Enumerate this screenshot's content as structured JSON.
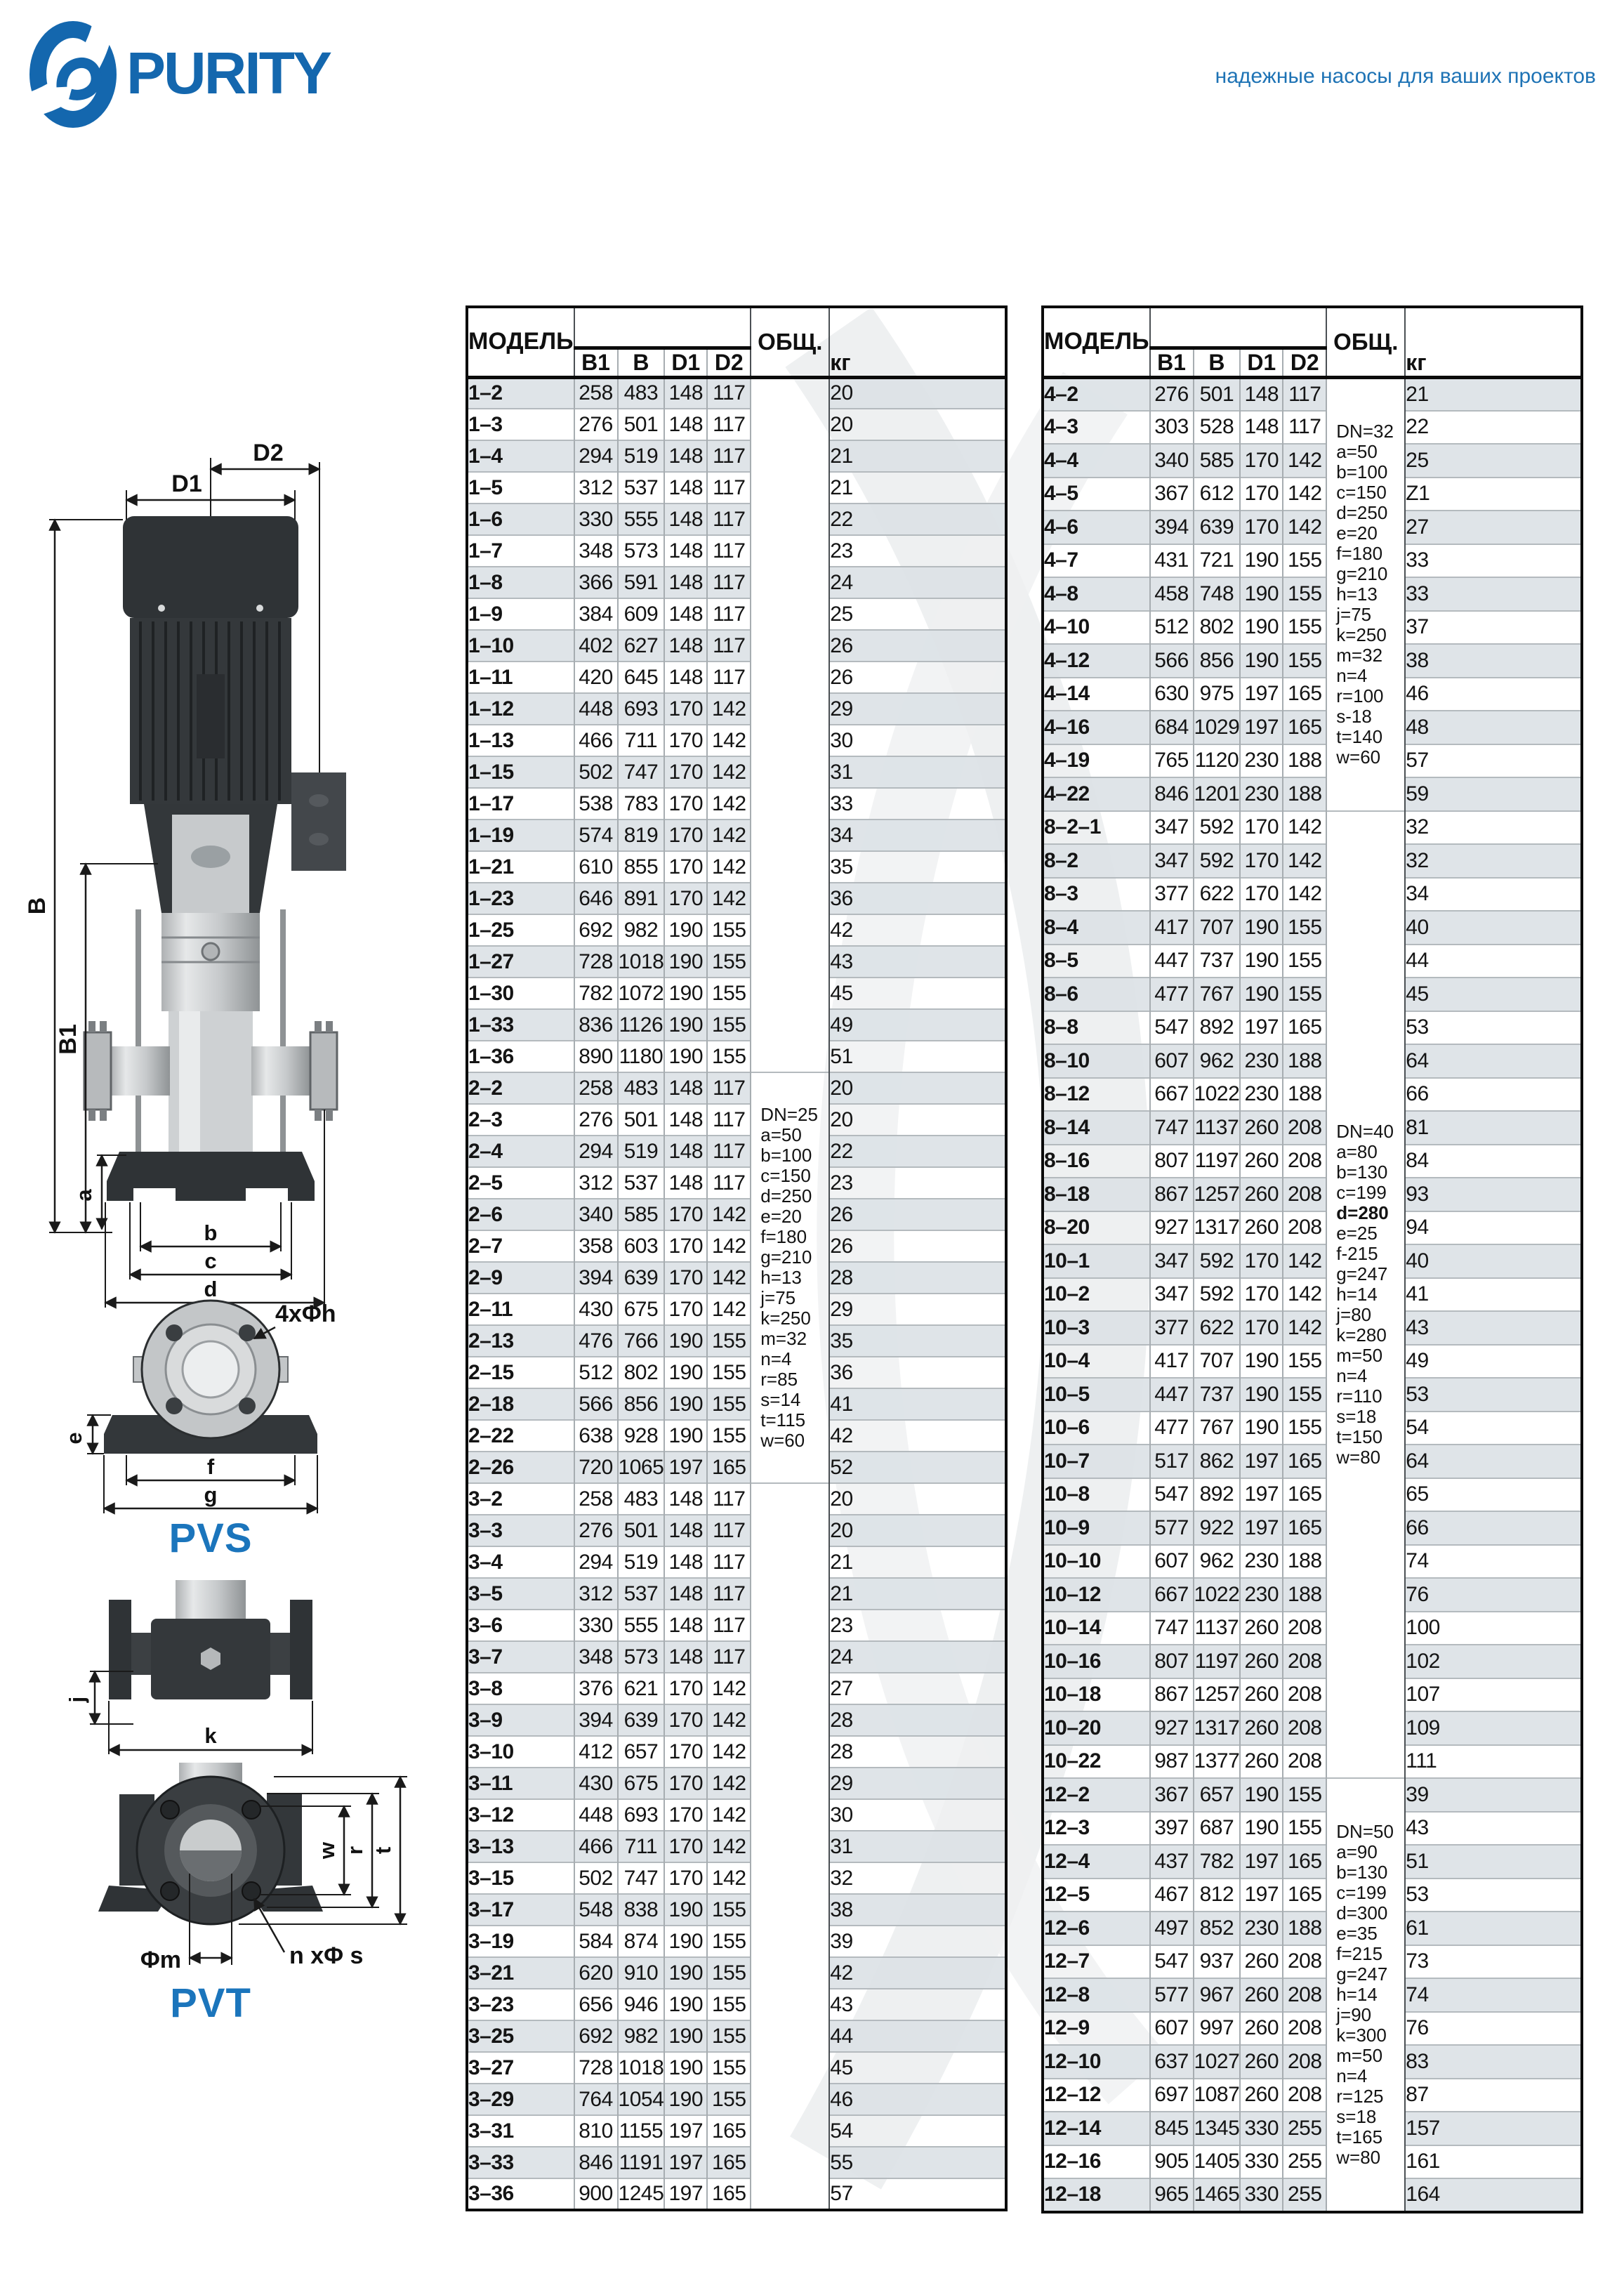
{
  "header": {
    "brand": "PURITY",
    "tagline": "надежные насосы для ваших проектов",
    "brand_color": "#1467ae",
    "accent_blue": "#1b75bc"
  },
  "diagram": {
    "dim_d2": "D2",
    "dim_d1": "D1",
    "dim_b": "B",
    "dim_b1": "B1",
    "dim_a": "a",
    "dim_b_small": "b",
    "dim_c": "c",
    "dim_d_small": "d",
    "dim_e": "e",
    "dim_f": "f",
    "dim_g": "g",
    "bolt_note_pvs": "4xΦh",
    "dim_j": "j",
    "dim_k": "k",
    "dim_m": "Φm",
    "bolt_note_pvt": "n xΦ s",
    "dim_w": "w",
    "dim_r": "r",
    "dim_t": "t",
    "pvs_label": "PVS",
    "pvt_label": "PVT"
  },
  "tables": [
    {
      "headers": {
        "model": "МОДЕЛЬ",
        "b1": "B1",
        "b": "B",
        "d1": "D1",
        "d2": "D2",
        "common": "ОБЩ.",
        "kg": "кг"
      },
      "group_starts": [
        22,
        35
      ],
      "note_cells": [
        {
          "start": 0,
          "span": 22,
          "lines": []
        },
        {
          "start": 22,
          "span": 13,
          "lines": [
            "DN=25",
            "a=50",
            "b=100",
            "c=150",
            "d=250",
            "e=20",
            "f=180",
            "g=210",
            "h=13",
            "j=75",
            "k=250",
            "m=32",
            "n=4",
            "r=85",
            "s=14",
            "t=115",
            "w=60"
          ]
        },
        {
          "start": 35,
          "span": 23,
          "lines": []
        }
      ],
      "rows": [
        [
          "1–2",
          258,
          483,
          148,
          117,
          20
        ],
        [
          "1–3",
          276,
          501,
          148,
          117,
          20
        ],
        [
          "1–4",
          294,
          519,
          148,
          117,
          21
        ],
        [
          "1–5",
          312,
          537,
          148,
          117,
          21
        ],
        [
          "1–6",
          330,
          555,
          148,
          117,
          22
        ],
        [
          "1–7",
          348,
          573,
          148,
          117,
          23
        ],
        [
          "1–8",
          366,
          591,
          148,
          117,
          24
        ],
        [
          "1–9",
          384,
          609,
          148,
          117,
          25
        ],
        [
          "1–10",
          402,
          627,
          148,
          117,
          26
        ],
        [
          "1–11",
          420,
          645,
          148,
          117,
          26
        ],
        [
          "1–12",
          448,
          693,
          170,
          142,
          29
        ],
        [
          "1–13",
          466,
          711,
          170,
          142,
          30
        ],
        [
          "1–15",
          502,
          747,
          170,
          142,
          31
        ],
        [
          "1–17",
          538,
          783,
          170,
          142,
          33
        ],
        [
          "1–19",
          574,
          819,
          170,
          142,
          34
        ],
        [
          "1–21",
          610,
          855,
          170,
          142,
          35
        ],
        [
          "1–23",
          646,
          891,
          170,
          142,
          36
        ],
        [
          "1–25",
          692,
          982,
          190,
          155,
          42
        ],
        [
          "1–27",
          728,
          1018,
          190,
          155,
          43
        ],
        [
          "1–30",
          782,
          1072,
          190,
          155,
          45
        ],
        [
          "1–33",
          836,
          1126,
          190,
          155,
          49
        ],
        [
          "1–36",
          890,
          1180,
          190,
          155,
          51
        ],
        [
          "2–2",
          258,
          483,
          148,
          117,
          20
        ],
        [
          "2–3",
          276,
          501,
          148,
          117,
          20
        ],
        [
          "2–4",
          294,
          519,
          148,
          117,
          22
        ],
        [
          "2–5",
          312,
          537,
          148,
          117,
          23
        ],
        [
          "2–6",
          340,
          585,
          170,
          142,
          26
        ],
        [
          "2–7",
          358,
          603,
          170,
          142,
          26
        ],
        [
          "2–9",
          394,
          639,
          170,
          142,
          28
        ],
        [
          "2–11",
          430,
          675,
          170,
          142,
          29
        ],
        [
          "2–13",
          476,
          766,
          190,
          155,
          35
        ],
        [
          "2–15",
          512,
          802,
          190,
          155,
          36
        ],
        [
          "2–18",
          566,
          856,
          190,
          155,
          41
        ],
        [
          "2–22",
          638,
          928,
          190,
          155,
          42
        ],
        [
          "2–26",
          720,
          1065,
          197,
          165,
          52
        ],
        [
          "3–2",
          258,
          483,
          148,
          117,
          20
        ],
        [
          "3–3",
          276,
          501,
          148,
          117,
          20
        ],
        [
          "3–4",
          294,
          519,
          148,
          117,
          21
        ],
        [
          "3–5",
          312,
          537,
          148,
          117,
          21
        ],
        [
          "3–6",
          330,
          555,
          148,
          117,
          23
        ],
        [
          "3–7",
          348,
          573,
          148,
          117,
          24
        ],
        [
          "3–8",
          376,
          621,
          170,
          142,
          27
        ],
        [
          "3–9",
          394,
          639,
          170,
          142,
          28
        ],
        [
          "3–10",
          412,
          657,
          170,
          142,
          28
        ],
        [
          "3–11",
          430,
          675,
          170,
          142,
          29
        ],
        [
          "3–12",
          448,
          693,
          170,
          142,
          30
        ],
        [
          "3–13",
          466,
          711,
          170,
          142,
          31
        ],
        [
          "3–15",
          502,
          747,
          170,
          142,
          32
        ],
        [
          "3–17",
          548,
          838,
          190,
          155,
          38
        ],
        [
          "3–19",
          584,
          874,
          190,
          155,
          39
        ],
        [
          "3–21",
          620,
          910,
          190,
          155,
          42
        ],
        [
          "3–23",
          656,
          946,
          190,
          155,
          43
        ],
        [
          "3–25",
          692,
          982,
          190,
          155,
          44
        ],
        [
          "3–27",
          728,
          1018,
          190,
          155,
          45
        ],
        [
          "3–29",
          764,
          1054,
          190,
          155,
          46
        ],
        [
          "3–31",
          810,
          1155,
          197,
          165,
          54
        ],
        [
          "3–33",
          846,
          1191,
          197,
          165,
          55
        ],
        [
          "3–36",
          900,
          1245,
          197,
          165,
          57
        ]
      ]
    },
    {
      "headers": {
        "model": "МОДЕЛЬ",
        "b1": "B1",
        "b": "B",
        "d1": "D1",
        "d2": "D2",
        "common": "ОБЩ.",
        "kg": "кг"
      },
      "group_starts": [
        13,
        26,
        42
      ],
      "note_cells": [
        {
          "start": 0,
          "span": 13,
          "lines": [
            "DN=32",
            "a=50",
            "b=100",
            "c=150",
            "d=250",
            "e=20",
            "f=180",
            "g=210",
            "h=13",
            "j=75",
            "k=250",
            "m=32",
            "n=4",
            "r=100",
            "s-18",
            "t=140",
            "w=60"
          ]
        },
        {
          "start": 13,
          "span": 29,
          "lines": [
            "DN=40",
            "a=80",
            "b=130",
            "c=199",
            {
              "t": "d=280",
              "bold": true
            },
            "e=25",
            "f-215",
            "g=247",
            "h=14",
            "j=80",
            "k=280",
            "m=50",
            "n=4",
            "r=110",
            "s=18",
            "t=150",
            "w=80"
          ]
        },
        {
          "start": 42,
          "span": 13,
          "lines": [
            "DN=50",
            "a=90",
            "b=130",
            "c=199",
            "d=300",
            "e=35",
            "f=215",
            "g=247",
            "h=14",
            "j=90",
            "k=300",
            "m=50",
            "n=4",
            "r=125",
            "s=18",
            "t=165",
            "w=80"
          ]
        }
      ],
      "rows": [
        [
          "4–2",
          276,
          501,
          148,
          117,
          21
        ],
        [
          "4–3",
          303,
          528,
          148,
          117,
          22
        ],
        [
          "4–4",
          340,
          585,
          170,
          142,
          25
        ],
        [
          "4–5",
          367,
          612,
          170,
          142,
          "Z1"
        ],
        [
          "4–6",
          394,
          639,
          170,
          142,
          27
        ],
        [
          "4–7",
          431,
          721,
          190,
          155,
          33
        ],
        [
          "4–8",
          458,
          748,
          190,
          155,
          33
        ],
        [
          "4–10",
          512,
          802,
          190,
          155,
          37
        ],
        [
          "4–12",
          566,
          856,
          190,
          155,
          38
        ],
        [
          "4–14",
          630,
          975,
          197,
          165,
          46
        ],
        [
          "4–16",
          684,
          1029,
          197,
          165,
          48
        ],
        [
          "4–19",
          765,
          1120,
          230,
          188,
          57
        ],
        [
          "4–22",
          846,
          1201,
          230,
          188,
          59
        ],
        [
          "8–2–1",
          347,
          592,
          170,
          142,
          32
        ],
        [
          "8–2",
          347,
          592,
          170,
          142,
          32
        ],
        [
          "8–3",
          377,
          622,
          170,
          142,
          34
        ],
        [
          "8–4",
          417,
          707,
          190,
          155,
          40
        ],
        [
          "8–5",
          447,
          737,
          190,
          155,
          44
        ],
        [
          "8–6",
          477,
          767,
          190,
          155,
          45
        ],
        [
          "8–8",
          547,
          892,
          197,
          165,
          53
        ],
        [
          "8–10",
          607,
          962,
          230,
          188,
          64
        ],
        [
          "8–12",
          667,
          1022,
          230,
          188,
          66
        ],
        [
          "8–14",
          747,
          1137,
          260,
          208,
          81
        ],
        [
          "8–16",
          807,
          1197,
          260,
          208,
          84
        ],
        [
          "8–18",
          867,
          1257,
          260,
          208,
          93
        ],
        [
          "8–20",
          927,
          1317,
          260,
          208,
          94
        ],
        [
          "10–1",
          347,
          592,
          170,
          142,
          40
        ],
        [
          "10–2",
          347,
          592,
          170,
          142,
          41
        ],
        [
          "10–3",
          377,
          622,
          170,
          142,
          43
        ],
        [
          "10–4",
          417,
          707,
          190,
          155,
          49
        ],
        [
          "10–5",
          447,
          737,
          190,
          155,
          53
        ],
        [
          "10–6",
          477,
          767,
          190,
          155,
          54
        ],
        [
          "10–7",
          517,
          862,
          197,
          165,
          64
        ],
        [
          "10–8",
          547,
          892,
          197,
          165,
          65
        ],
        [
          "10–9",
          577,
          922,
          197,
          165,
          66
        ],
        [
          "10–10",
          607,
          962,
          230,
          188,
          74
        ],
        [
          "10–12",
          667,
          1022,
          230,
          188,
          76
        ],
        [
          "10–14",
          747,
          1137,
          260,
          208,
          100
        ],
        [
          "10–16",
          807,
          1197,
          260,
          208,
          102
        ],
        [
          "10–18",
          867,
          1257,
          260,
          208,
          107
        ],
        [
          "10–20",
          927,
          1317,
          260,
          208,
          109
        ],
        [
          "10–22",
          987,
          1377,
          260,
          208,
          111
        ],
        [
          "12–2",
          367,
          657,
          190,
          155,
          39
        ],
        [
          "12–3",
          397,
          687,
          190,
          155,
          43
        ],
        [
          "12–4",
          437,
          782,
          197,
          165,
          51
        ],
        [
          "12–5",
          467,
          812,
          197,
          165,
          53
        ],
        [
          "12–6",
          497,
          852,
          230,
          188,
          61
        ],
        [
          "12–7",
          547,
          937,
          260,
          208,
          73
        ],
        [
          "12–8",
          577,
          967,
          260,
          208,
          74
        ],
        [
          "12–9",
          607,
          997,
          260,
          208,
          76
        ],
        [
          "12–10",
          637,
          1027,
          260,
          208,
          83
        ],
        [
          "12–12",
          697,
          1087,
          260,
          208,
          87
        ],
        [
          "12–14",
          845,
          1345,
          330,
          255,
          157
        ],
        [
          "12–16",
          905,
          1405,
          330,
          255,
          161
        ],
        [
          "12–18",
          965,
          1465,
          330,
          255,
          164
        ]
      ]
    }
  ]
}
